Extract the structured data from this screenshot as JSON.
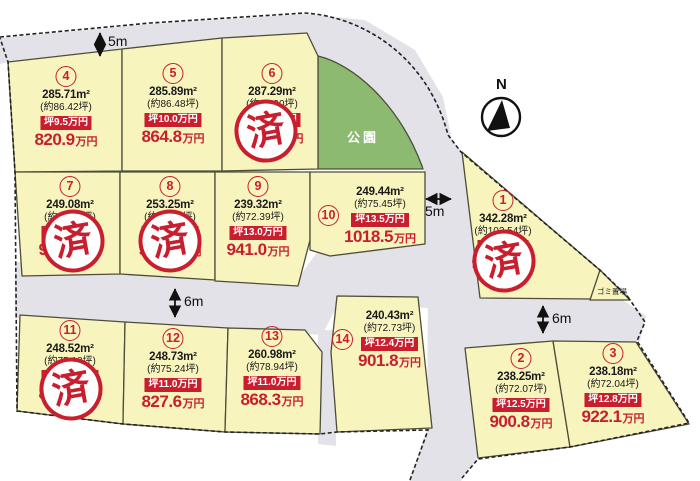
{
  "map": {
    "park_label": "公園",
    "north_label": "N",
    "garbage_label": "ゴミ置場",
    "sold_stamp": "済",
    "road_labels": {
      "top": "5m",
      "center": "5m",
      "left": "6m",
      "right": "6m"
    },
    "colors": {
      "plot_fill": "#f8f4be",
      "road_fill": "#e2e2e8",
      "park_fill": "#8cba70",
      "accent_red": "#c81e2e",
      "outline": "#4d4d3a"
    },
    "plots": [
      {
        "id": "1",
        "number": "1",
        "area": "342.28m²",
        "tsubo": "(約103.54坪)",
        "unit_price": "坪9.5万円",
        "price": "983.6",
        "price_unit": "万円",
        "sold": true
      },
      {
        "id": "2",
        "number": "2",
        "area": "238.25m²",
        "tsubo": "(約72.07坪)",
        "unit_price": "坪12.5万円",
        "price": "900.8",
        "price_unit": "万円",
        "sold": false
      },
      {
        "id": "3",
        "number": "3",
        "area": "238.18m²",
        "tsubo": "(約72.04坪)",
        "unit_price": "坪12.8万円",
        "price": "922.1",
        "price_unit": "万円",
        "sold": false
      },
      {
        "id": "4",
        "number": "4",
        "area": "285.71m²",
        "tsubo": "(約86.42坪)",
        "unit_price": "坪9.5万円",
        "price": "820.9",
        "price_unit": "万円",
        "sold": false
      },
      {
        "id": "5",
        "number": "5",
        "area": "285.89m²",
        "tsubo": "(約86.48坪)",
        "unit_price": "坪10.0万円",
        "price": "864.8",
        "price_unit": "万円",
        "sold": false
      },
      {
        "id": "6",
        "number": "6",
        "area": "287.29m²",
        "tsubo": "(約86.90坪)",
        "unit_price": "坪10.0万円",
        "price": "869.0",
        "price_unit": "万円",
        "sold": true
      },
      {
        "id": "7",
        "number": "7",
        "area": "249.08m²",
        "tsubo": "(約75.35坪)",
        "unit_price": "坪12.5万円",
        "price": "941.9",
        "price_unit": "万円",
        "sold": true
      },
      {
        "id": "8",
        "number": "8",
        "area": "253.25m²",
        "tsubo": "(約76.61坪)",
        "unit_price": "坪12.5万円",
        "price": "957.6",
        "price_unit": "万円",
        "sold": true
      },
      {
        "id": "9",
        "number": "9",
        "area": "239.32m²",
        "tsubo": "(約72.39坪)",
        "unit_price": "坪13.0万円",
        "price": "941.0",
        "price_unit": "万円",
        "sold": false
      },
      {
        "id": "10",
        "number": "10",
        "area": "249.44m²",
        "tsubo": "(約75.45坪)",
        "unit_price": "坪13.5万円",
        "price": "1018.5",
        "price_unit": "万円",
        "sold": false
      },
      {
        "id": "11",
        "number": "11",
        "area": "248.52m²",
        "tsubo": "(約75.18坪)",
        "unit_price": "坪11.0万円",
        "price": "827.0",
        "price_unit": "万円",
        "sold": true
      },
      {
        "id": "12",
        "number": "12",
        "area": "248.73m²",
        "tsubo": "(約75.24坪)",
        "unit_price": "坪11.0万円",
        "price": "827.6",
        "price_unit": "万円",
        "sold": false
      },
      {
        "id": "13",
        "number": "13",
        "area": "260.98m²",
        "tsubo": "(約78.94坪)",
        "unit_price": "坪11.0万円",
        "price": "868.3",
        "price_unit": "万円",
        "sold": false
      },
      {
        "id": "14",
        "number": "14",
        "area": "240.43m²",
        "tsubo": "(約72.73坪)",
        "unit_price": "坪12.4万円",
        "price": "901.8",
        "price_unit": "万円",
        "sold": false
      }
    ]
  }
}
